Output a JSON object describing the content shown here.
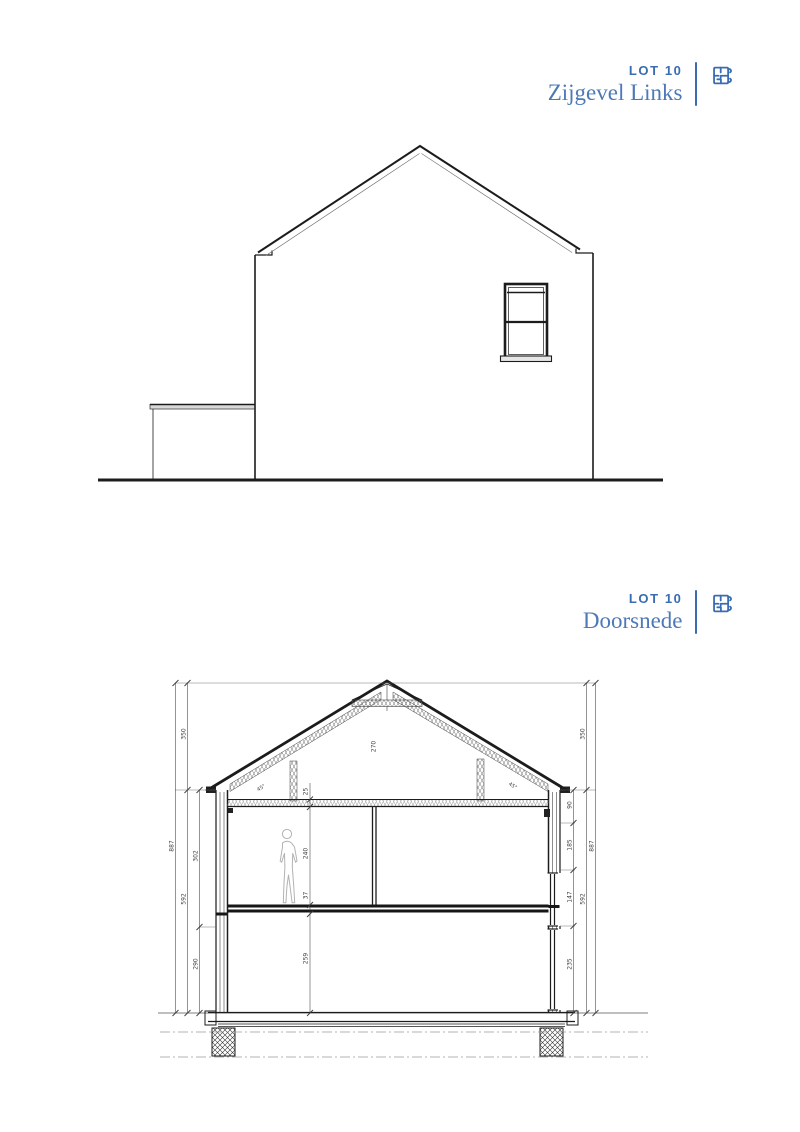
{
  "sheet": {
    "background": "#ffffff",
    "accent_color": "#3a6cb2",
    "title_color": "#4d79b8",
    "line_color": "#1c1c1c"
  },
  "headers": [
    {
      "lot": "LOT 10",
      "title": "Zijgevel Links",
      "icon": "blueprint-icon"
    },
    {
      "lot": "LOT 10",
      "title": "Doorsnede",
      "icon": "blueprint-icon"
    }
  ],
  "section": {
    "dims": {
      "left_outer": "887",
      "left_roof": "350",
      "left_storey": "592",
      "left_upper": "302",
      "left_lower": "290",
      "right_head": "90",
      "right_window": "185",
      "right_sill": "147",
      "right_lower": "235",
      "right_roof": "350",
      "right_storey": "592",
      "right_outer": "887",
      "attic_floor": "25",
      "room_height": "240",
      "floor_pack": "37",
      "ground_height": "259",
      "ridge": "270",
      "slope_left": "45°",
      "slope_right": "45°"
    }
  }
}
